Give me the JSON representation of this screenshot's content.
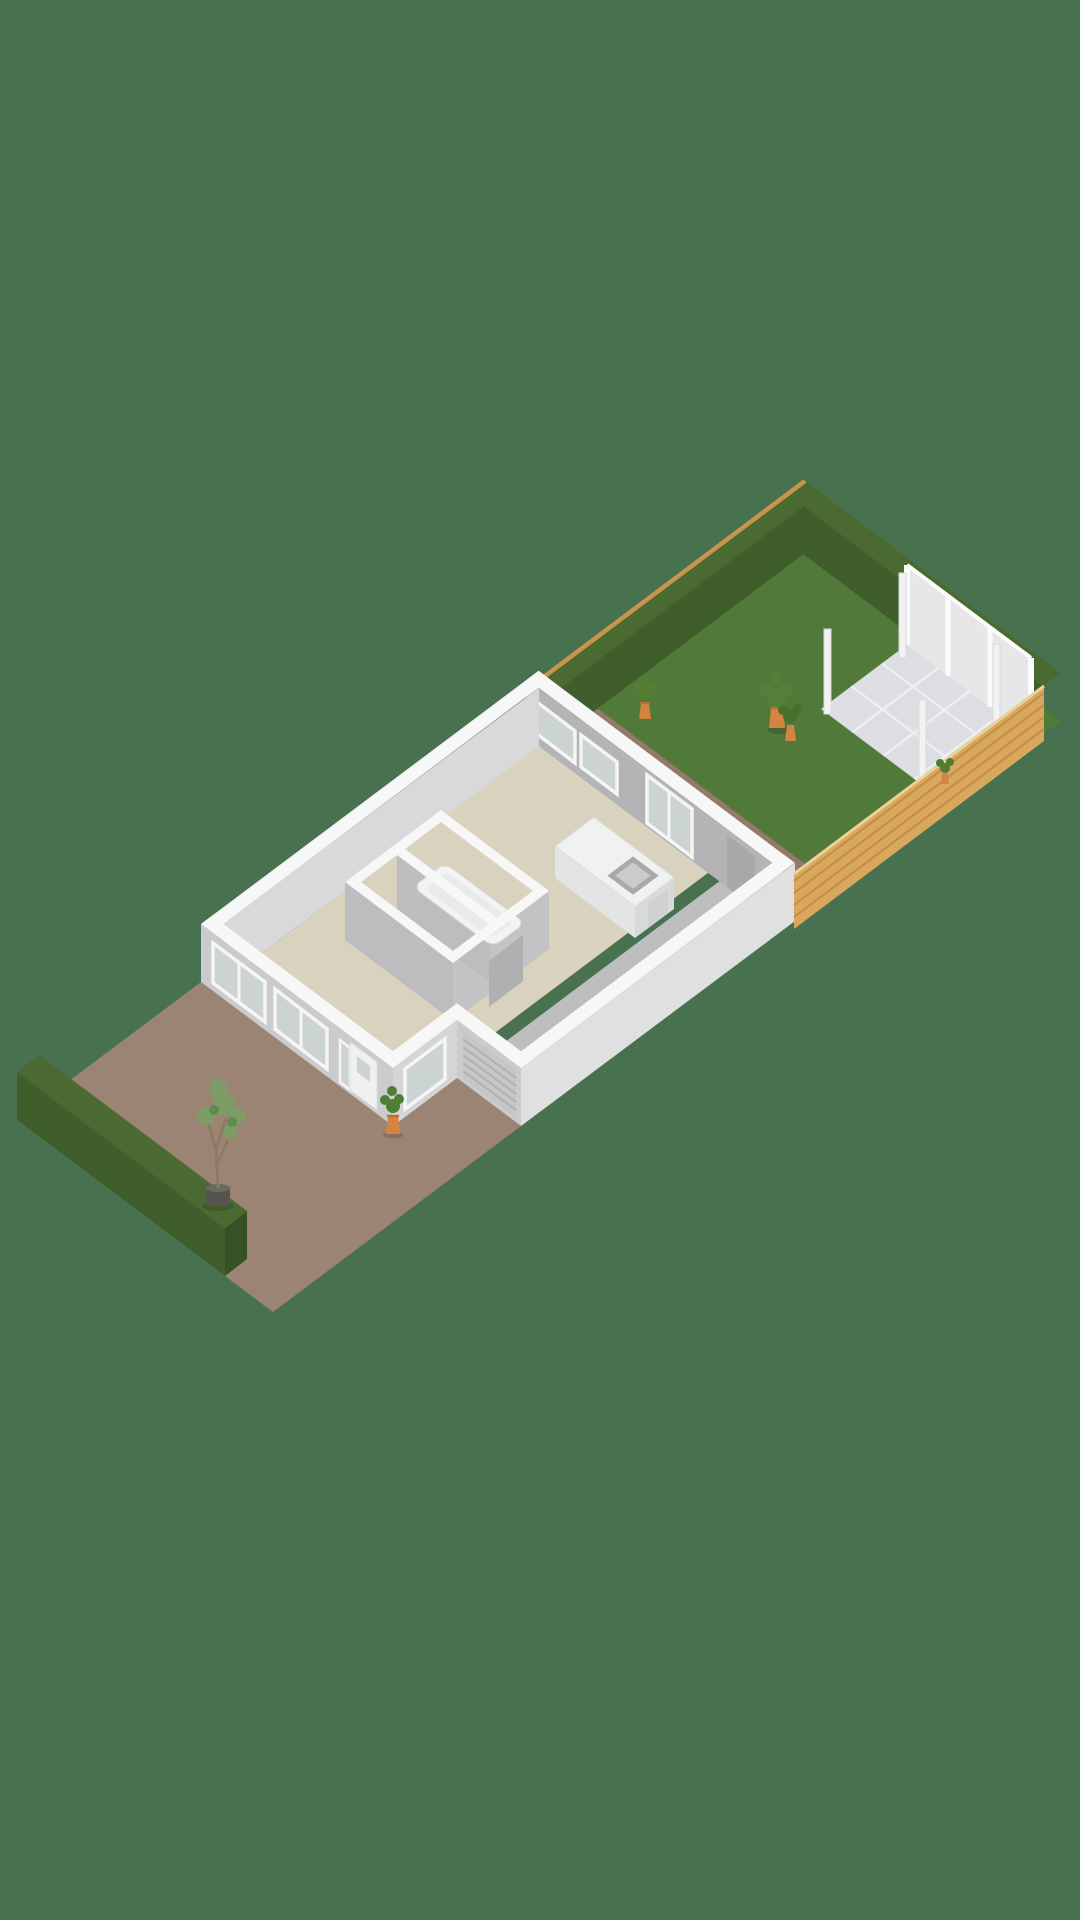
{
  "scene": {
    "kind": "isometric-3d-floorplan-render",
    "description": "Dollhouse 3D floor plan of a single-storey house with driveway, garage, bathroom block, kitchen island, back path, lawn garden, tiled patio, privacy screens, hedges, wooden fence and potted plants",
    "objects": {
      "background": "flat green backdrop",
      "driveway": "brown paved front yard",
      "front_hedge": "dark green hedge along driveway",
      "house": "white cut-away walls with beige floor",
      "garage": "grey floor room with roller door",
      "bathroom_block": "interior room cluster with bath tub",
      "kitchen_island": "white island with sink",
      "back_path": "brown paved path behind house",
      "lawn": "green garden lawn",
      "patio": "light grey tiled terrace with four pergola posts",
      "privacy_screens": "three white screen panels",
      "wood_fence": "horizontal slat fence on garden side",
      "plants": "orange pots with green plants and a small tree in a planter box"
    }
  },
  "palette": {
    "background": "#47714f",
    "lawn": "#50793a",
    "lawn_edge": "#466d2e",
    "hedge_top": "#4a6a31",
    "hedge_face": "#3f5e2c",
    "hedge_face_dark": "#365126",
    "wood_fence": "#d9a75d",
    "wood_slat": "#c28e45",
    "wood_cap": "#c8954e",
    "wood_top": "#ecd09a",
    "paving": "#9c8474",
    "paving_dark": "#937b6b",
    "patio_tile": "#dcdee1",
    "patio_joint": "#edeff1",
    "floor": "#d9d2bf",
    "bath_floor": "#d6d4cd",
    "garage_floor": "#bdbdc0",
    "wall_top": "#f7f7f8",
    "wall_front": "#cbcbce",
    "wall_side": "#e0e0e2",
    "wall_step": "#d5d5d7",
    "wall_inner": "#b4b4b7",
    "wall_inner_light": "#d9d9db",
    "inner_door": "#a8a8ab",
    "glass": "#ccd4d2",
    "door": "#f0f0f1",
    "roller_door": "#c6c6c9",
    "roller_line": "#b0b0b3",
    "screen_panel": "#e7e7e9",
    "screen_frame": "#fbfbfc",
    "post": "#f2f2f3",
    "pot": "#d28440",
    "pot_dark": "#b96f33",
    "plant": "#4e7d33",
    "plant_light": "#7ca065",
    "plant_dark": "#5f8c4e",
    "tub": "#f3f3f3",
    "tub_inner": "#e9eaea",
    "island": "#f0f1f1",
    "island_face": "#e3e4e4",
    "island_face_dark": "#d8d9da",
    "sink": "#a7a9ac",
    "planter": "#55544f",
    "planter_top": "#6a6963",
    "trunk": "#8a7a5e"
  }
}
